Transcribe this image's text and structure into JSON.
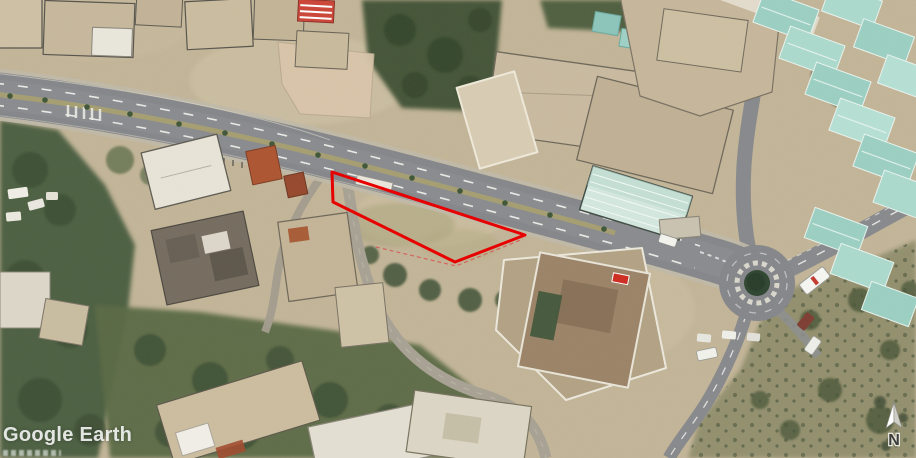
{
  "watermark": {
    "title": "Google Earth"
  },
  "north_indicator": {
    "label": "N"
  },
  "annotation": {
    "outline_points": "332,172 525,235 455,262 333,202",
    "outline_color": "#e60000",
    "dashed_points": "376,247 456,266 523,239",
    "dashed_color": "#d85050"
  },
  "colors": {
    "terrain_tan": "#c3b598",
    "vegetation_green": "#4e6042",
    "road_asphalt": "#85878b",
    "warehouse_roof_teal": "#a3d4c6",
    "parcel_outline_red": "#e60000",
    "watermark_white": "#ffffff"
  }
}
